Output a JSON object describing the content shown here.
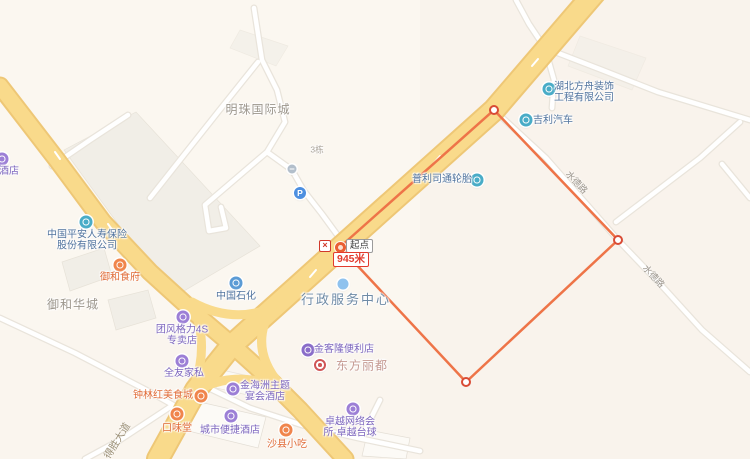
{
  "map": {
    "background": "#FBF7F0",
    "colors": {
      "road_fill": "#F9DA8B",
      "road_casing": "#EEC776",
      "white_road": "#FFFFFF",
      "white_road_casing": "#E9E4DB",
      "building": "#F1EEE7",
      "measure_line": "#EE7448",
      "vertex_stroke": "#D94B35",
      "icons": {
        "teal": "#49ACC7",
        "blue": "#5B9BD5",
        "purple": "#9C7FD6",
        "darkpurple": "#8A6DC9",
        "orange": "#F0854C",
        "parking": "#4D8FE0",
        "gate": "#B3BFCB",
        "dot": "#8FC2EE",
        "ring": "#D05656"
      },
      "text": {
        "blue": "#50739E",
        "purpletext": "#7D66BE",
        "orangetext": "#E06A36",
        "gray": "#9C968C",
        "steel": "#6F8BA6",
        "pink": "#C59A92",
        "purple": "#7D66BE",
        "tinygray": "#ABA49A"
      }
    },
    "pois": [
      {
        "id": "edge-hotel",
        "icon": {
          "x": 2,
          "y": 159,
          "type": "purple"
        },
        "text": {
          "x": 9,
          "y": 172,
          "lines": [
            "酒店"
          ],
          "color": "purple"
        }
      },
      {
        "id": "mingzhu-guojicheng",
        "text": {
          "x": 258,
          "y": 110,
          "lines": [
            "明珠国际城"
          ],
          "color": "gray",
          "size": 12,
          "ls": 1
        }
      },
      {
        "id": "building-3",
        "text": {
          "x": 317,
          "y": 150,
          "lines": [
            "3栋"
          ],
          "color": "tinygray",
          "size": 8.5
        }
      },
      {
        "id": "gate",
        "icon": {
          "x": 292,
          "y": 169,
          "type": "gate"
        }
      },
      {
        "id": "parking",
        "icon": {
          "x": 300,
          "y": 193,
          "type": "parking",
          "glyph": "P"
        }
      },
      {
        "id": "hubei-fangzhou",
        "icon": {
          "x": 549,
          "y": 89,
          "type": "teal"
        },
        "text": {
          "x": 584,
          "y": 93,
          "lines": [
            "湖北方舟装饰",
            "工程有限公司"
          ],
          "color": "blue"
        }
      },
      {
        "id": "jili-qiche",
        "icon": {
          "x": 526,
          "y": 120,
          "type": "teal"
        },
        "text": {
          "x": 553,
          "y": 121,
          "lines": [
            "吉利汽车"
          ],
          "color": "blue"
        }
      },
      {
        "id": "pulisitong-luntai",
        "icon": {
          "x": 477,
          "y": 180,
          "type": "teal"
        },
        "text": {
          "x": 442,
          "y": 180,
          "lines": [
            "普利司通轮胎"
          ],
          "color": "blue"
        }
      },
      {
        "id": "zhongguo-pingan",
        "icon": {
          "x": 86,
          "y": 222,
          "type": "teal"
        },
        "text": {
          "x": 87,
          "y": 241,
          "lines": [
            "中国平安人寿保险",
            "股份有限公司"
          ],
          "color": "blue"
        }
      },
      {
        "id": "yuhe-shifu",
        "icon": {
          "x": 120,
          "y": 265,
          "type": "orange"
        },
        "text": {
          "x": 120,
          "y": 278,
          "lines": [
            "御和食府"
          ],
          "color": "orangetext"
        }
      },
      {
        "id": "yuhe-huacheng",
        "text": {
          "x": 73,
          "y": 305,
          "lines": [
            "御和华城"
          ],
          "color": "gray",
          "size": 12,
          "ls": 1
        }
      },
      {
        "id": "zhongguo-shihua",
        "icon": {
          "x": 236,
          "y": 283,
          "type": "blue"
        },
        "text": {
          "x": 236,
          "y": 297,
          "lines": [
            "中国石化"
          ],
          "color": "blue"
        }
      },
      {
        "id": "xingzheng-fuwu-zhongxin",
        "icon": {
          "x": 343,
          "y": 284,
          "type": "dot"
        },
        "text": {
          "x": 346,
          "y": 300,
          "lines": [
            "行政服务中心"
          ],
          "color": "steel",
          "size": 13,
          "ls": 2
        }
      },
      {
        "id": "tuanfeng-geli-4s",
        "icon": {
          "x": 183,
          "y": 317,
          "type": "purple"
        },
        "text": {
          "x": 182,
          "y": 336,
          "lines": [
            "团风格力4S",
            "专卖店"
          ],
          "color": "purpletext"
        }
      },
      {
        "id": "quanyou-jiasi",
        "icon": {
          "x": 182,
          "y": 361,
          "type": "purple"
        },
        "text": {
          "x": 184,
          "y": 374,
          "lines": [
            "全友家私"
          ],
          "color": "purpletext"
        }
      },
      {
        "id": "jinkelong-bianlidian",
        "icon": {
          "x": 308,
          "y": 350,
          "type": "darkpurple"
        },
        "text": {
          "x": 344,
          "y": 350,
          "lines": [
            "金客隆便利店"
          ],
          "color": "purpletext"
        }
      },
      {
        "id": "dongfang-lidu",
        "icon": {
          "x": 320,
          "y": 365,
          "type": "ring"
        },
        "text": {
          "x": 362,
          "y": 366,
          "lines": [
            "东方丽都"
          ],
          "color": "pink",
          "size": 12,
          "ls": 1
        }
      },
      {
        "id": "jinhaizhou-hotel",
        "icon": {
          "x": 233,
          "y": 389,
          "type": "purple"
        },
        "text": {
          "x": 265,
          "y": 392,
          "lines": [
            "金海洲主题",
            "宴会酒店"
          ],
          "color": "purpletext"
        }
      },
      {
        "id": "zhonglinhong-meishicheng",
        "icon": {
          "x": 201,
          "y": 396,
          "type": "orange"
        },
        "text": {
          "x": 163,
          "y": 396,
          "lines": [
            "钟林红美食城"
          ],
          "color": "orangetext"
        }
      },
      {
        "id": "kouweitang",
        "icon": {
          "x": 177,
          "y": 414,
          "type": "orange"
        },
        "text": {
          "x": 177,
          "y": 429,
          "lines": [
            "口味堂"
          ],
          "color": "orangetext"
        }
      },
      {
        "id": "chengshi-bianjie-hotel",
        "icon": {
          "x": 231,
          "y": 416,
          "type": "purple"
        },
        "text": {
          "x": 230,
          "y": 431,
          "lines": [
            "城市便捷酒店"
          ],
          "color": "purpletext"
        }
      },
      {
        "id": "shaxian-xiaochi",
        "icon": {
          "x": 286,
          "y": 430,
          "type": "orange"
        },
        "text": {
          "x": 287,
          "y": 445,
          "lines": [
            "沙县小吃"
          ],
          "color": "orangetext"
        }
      },
      {
        "id": "zhuoyue-wangluo",
        "icon": {
          "x": 353,
          "y": 409,
          "type": "purple"
        },
        "text": {
          "x": 350,
          "y": 428,
          "lines": [
            "卓越网络会",
            "所·卓越台球"
          ],
          "color": "purpletext"
        }
      }
    ],
    "road_labels": [
      {
        "id": "desheng-dadao",
        "text": "得胜大道",
        "x": 116,
        "y": 440,
        "rot": -58,
        "color": "#9A8E74",
        "size": 10
      },
      {
        "id": "shuide-road-1",
        "text": "水德路",
        "x": 577,
        "y": 182,
        "rot": 47,
        "color": "#9A938A",
        "size": 9
      },
      {
        "id": "shuide-road-2",
        "text": "水德路",
        "x": 654,
        "y": 276,
        "rot": 47,
        "color": "#9A938A",
        "size": 9
      }
    ],
    "measure": {
      "start_label": "起点",
      "distance_label": "945米",
      "close_symbol": "×",
      "points": [
        [
          340,
          247
        ],
        [
          494,
          110
        ],
        [
          618,
          240
        ],
        [
          466,
          382
        ]
      ]
    }
  }
}
